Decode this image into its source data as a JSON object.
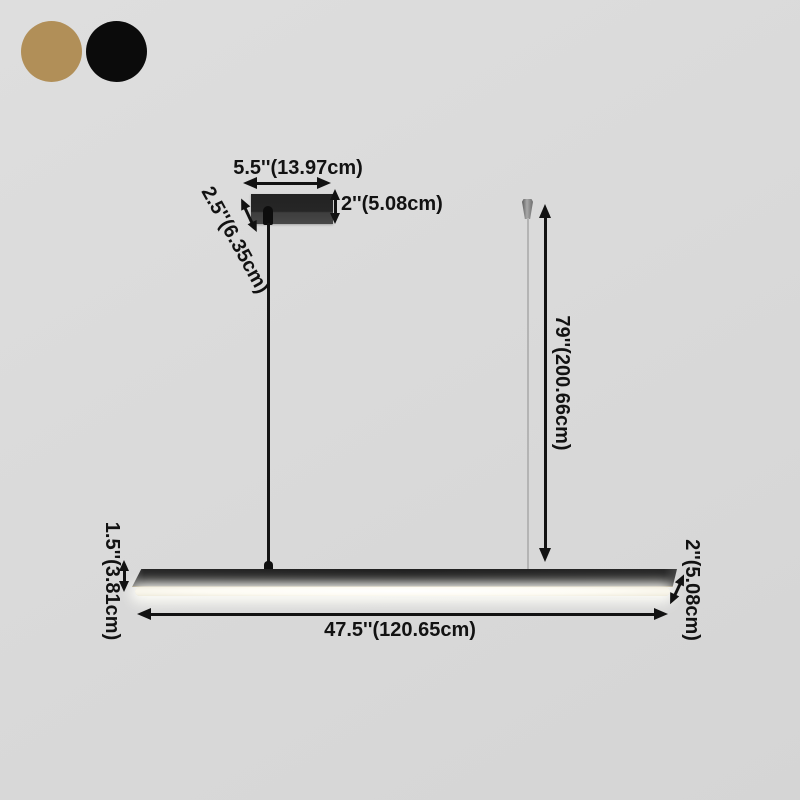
{
  "product_diagram": {
    "title_semantic": "linear-pendant-light-dimension-diagram",
    "swatches": [
      {
        "name": "gold",
        "color": "#b18f58"
      },
      {
        "name": "black",
        "color": "#0b0b0b"
      }
    ],
    "labels": {
      "canopy_width": "5.5''(13.97cm)",
      "canopy_depth": "2.5''(6.35cm)",
      "canopy_height": "2''(5.08cm)",
      "suspension_height": "79''(200.66cm)",
      "bar_height": "1.5''(3.81cm)",
      "bar_length": "47.5''(120.65cm)",
      "bar_depth": "2''(5.08cm)"
    },
    "colors": {
      "background": "#d9d9d9",
      "fixture_body": "#262626",
      "annotation": "#121212",
      "led_strip": "#fffdf2",
      "cable_right": "#b4b4b4"
    }
  }
}
